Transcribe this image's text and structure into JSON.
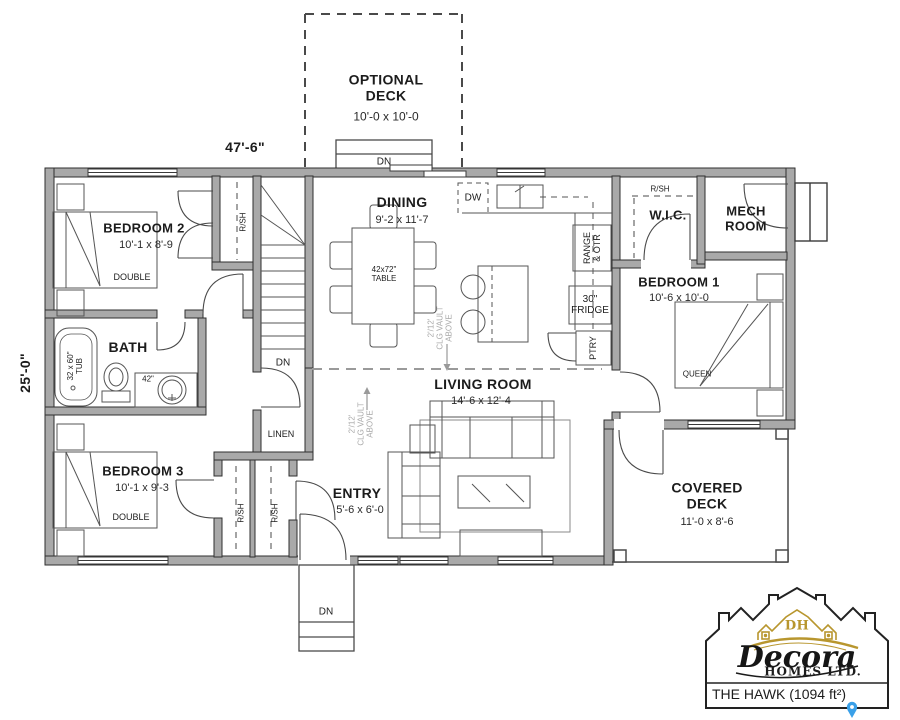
{
  "plan": {
    "width_dim": "47'-6\"",
    "height_dim": "25'-0\"",
    "optional_deck_name": "OPTIONAL DECK",
    "optional_deck_dims": "10'-0 x 10'-0",
    "bedroom2_name": "BEDROOM 2",
    "bedroom2_dims": "10'-1 x 8'-9",
    "bedroom2_bed": "DOUBLE",
    "bedroom3_name": "BEDROOM 3",
    "bedroom3_dims": "10'-1 x 9'-3",
    "bedroom3_bed": "DOUBLE",
    "bedroom1_name": "BEDROOM 1",
    "bedroom1_dims": "10'-6 x 10'-0",
    "bedroom1_bed": "QUEEN",
    "dining_name": "DINING",
    "dining_dims": "9'-2 x 11'-7",
    "dining_table": "42x72\" TABLE",
    "living_name": "LIVING ROOM",
    "living_dims": "14'-6 x 12'-4",
    "entry_name": "ENTRY",
    "entry_dims": "5'-6 x 6'-0",
    "covered_deck_name": "COVERED DECK",
    "covered_deck_dims": "11'-0 x 8'-6",
    "bath_name": "BATH",
    "tub_label": "32 x 60\" TUB",
    "vanity_label": "42\"",
    "wic_name": "W.I.C.",
    "mech_name": "MECH ROOM",
    "linen_label": "LINEN",
    "dw_label": "DW",
    "fridge_label": "30\" FRIDGE",
    "range_label": "RANGE & OTR",
    "pantry_label": "PTRY",
    "dn_label": "DN",
    "rsh_label": "R/SH",
    "vault_line1": "2'/12'",
    "vault_line2": "CLG VAULT",
    "vault_line3": "ABOVE"
  },
  "logo": {
    "monogram": "DH",
    "brand": "Decora",
    "subtitle": "HOMES LTD.",
    "model_label": "THE HAWK (1094 ft²)"
  },
  "colors": {
    "wall_fill": "#a9a9a9",
    "line": "#444444",
    "gold": "#b8962e",
    "pin_blue": "#3aa0e8"
  }
}
